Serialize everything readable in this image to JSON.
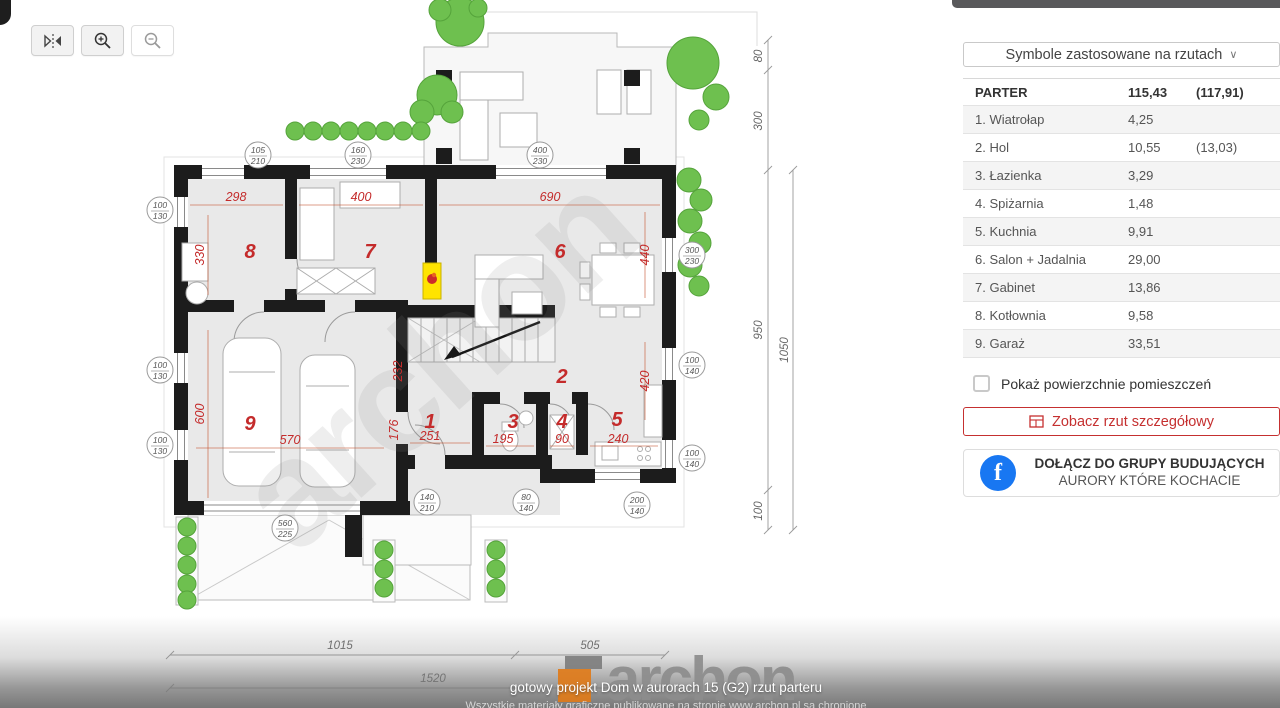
{
  "toolbar": {
    "buttons": [
      {
        "name": "flip-horizontal"
      },
      {
        "name": "zoom-in"
      },
      {
        "name": "zoom-out"
      }
    ]
  },
  "icons": {
    "chevron_down": "∨",
    "fb_letter": "f"
  },
  "sidebar": {
    "symbols_dropdown": "Symbole zastosowane na rzutach",
    "floor": {
      "label": "PARTER",
      "area": "115,43",
      "area2": "(117,91)"
    },
    "rooms": [
      {
        "label": "1. Wiatrołap",
        "area": "4,25",
        "area2": ""
      },
      {
        "label": "2. Hol",
        "area": "10,55",
        "area2": "(13,03)"
      },
      {
        "label": "3. Łazienka",
        "area": "3,29",
        "area2": ""
      },
      {
        "label": "4. Spiżarnia",
        "area": "1,48",
        "area2": ""
      },
      {
        "label": "5. Kuchnia",
        "area": "9,91",
        "area2": ""
      },
      {
        "label": "6. Salon + Jadalnia",
        "area": "29,00",
        "area2": ""
      },
      {
        "label": "7. Gabinet",
        "area": "13,86",
        "area2": ""
      },
      {
        "label": "8. Kotłownia",
        "area": "9,58",
        "area2": ""
      },
      {
        "label": "9. Garaż",
        "area": "33,51",
        "area2": ""
      }
    ],
    "checkbox_label": "Pokaż powierzchnie pomieszczeń",
    "detail_button_label": "Zobacz rzut szczegółowy",
    "fb_line1": "DOŁĄCZ DO GRUPY BUDUJĄCYCH",
    "fb_line2": "AURORY KTÓRE KOCHACIE"
  },
  "plan": {
    "watermark": "archon",
    "room_numbers": {
      "r1": "1",
      "r2": "2",
      "r3": "3",
      "r4": "4",
      "r5": "5",
      "r6": "6",
      "r7": "7",
      "r8": "8",
      "r9": "9"
    },
    "red_dims": {
      "d298": "298",
      "d400": "400",
      "d690": "690",
      "d330": "330",
      "d600": "600",
      "d570": "570",
      "d251": "251",
      "d176": "176",
      "d232": "232",
      "d195": "195",
      "d90": "90",
      "d240": "240",
      "d440": "440",
      "d420": "420"
    },
    "windows": [
      [
        "105",
        "210"
      ],
      [
        "160",
        "230"
      ],
      [
        "400",
        "230"
      ],
      [
        "100",
        "130"
      ],
      [
        "300",
        "230"
      ],
      [
        "100",
        "130"
      ],
      [
        "100",
        "130"
      ],
      [
        "100",
        "140"
      ],
      [
        "100",
        "140"
      ],
      [
        "140",
        "210"
      ],
      [
        "80",
        "140"
      ],
      [
        "200",
        "140"
      ],
      [
        "560",
        "225"
      ]
    ],
    "gray_dims": {
      "right": [
        "80",
        "300",
        "950",
        "1050",
        "100"
      ],
      "bottom": [
        "1015",
        "505",
        "1520"
      ]
    }
  },
  "footer": {
    "logo_text": "archon",
    "caption": "gotowy projekt Dom w aurorach 15 (G2) rzut parteru",
    "copyright": "Wszystkie materiały graficzne publikowane na stronie www.archon.pl są chronione"
  },
  "colors": {
    "accent_red": "#c53030",
    "facebook_blue": "#1877f2",
    "tree_green": "#6ec04f",
    "highlight_yellow": "#ffe400",
    "logo_orange": "#e07b1a"
  }
}
